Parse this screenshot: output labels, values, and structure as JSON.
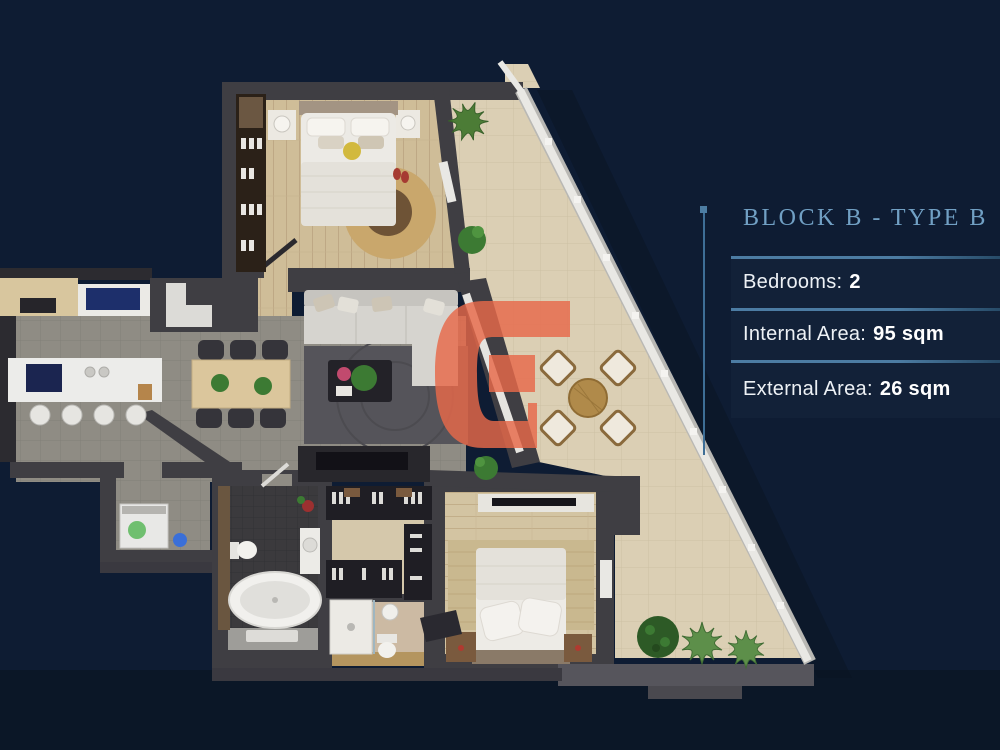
{
  "page": {
    "background_color": "#0e1c33"
  },
  "panel": {
    "title": "BLOCK B - TYPE B",
    "title_color": "#71a0c4",
    "accent_color": "#3e6e96",
    "rows": [
      {
        "label": "Bedrooms:",
        "value": "2"
      },
      {
        "label": "Internal Area:",
        "value": "95 sqm"
      },
      {
        "label": "External Area:",
        "value": "26 sqm"
      }
    ]
  },
  "watermark": {
    "shape": "letter-G-logo",
    "color": "#e8694a"
  },
  "floor_plan": {
    "description": "Top-down 3D render of a two-bedroom apartment with diagonal terrace edge and glass railing",
    "rooms": [
      "bedroom-1",
      "living-room",
      "kitchen-dining",
      "laundry",
      "bathroom",
      "walk-in-closet",
      "shower-room",
      "bedroom-2",
      "terrace"
    ]
  }
}
